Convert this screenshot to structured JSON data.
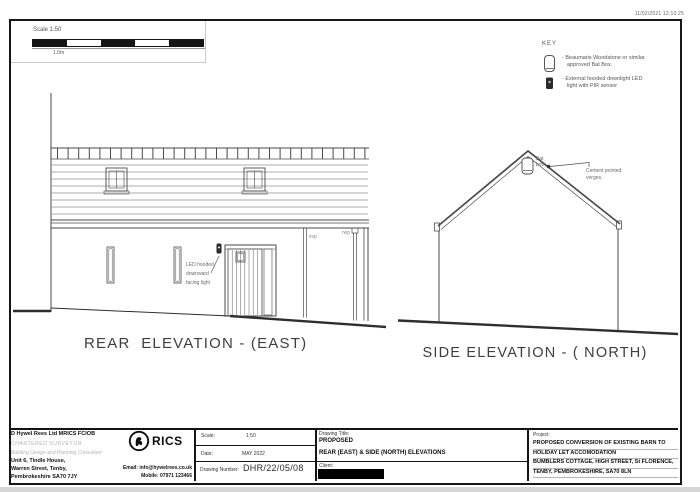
{
  "meta": {
    "timestamp": "11/02/2021 12:10:25"
  },
  "scale_bar": {
    "label": "Scale 1:50",
    "unit_label": "1.0m"
  },
  "key": {
    "title": "KEY",
    "item1_line1": "- Beaumaris Woodstone or similar",
    "item1_line2": "approved Bat Box.",
    "item2_line1": "- External hooded downlight LED",
    "item2_line2": "light with PIR sensor"
  },
  "rear_elevation": {
    "title": "REAR  ELEVATION - (EAST)",
    "led_note_line1": "LED hooded",
    "led_note_line2": "downward",
    "led_note_line3": "facing light",
    "svp_label": "svp",
    "rwp_label": "rwp"
  },
  "side_elevation": {
    "title": "SIDE ELEVATION - ( NORTH)",
    "bat_box_line1": "Bat",
    "bat_box_line2": "box",
    "verges_line1": "Cement pointed",
    "verges_line2": "verges."
  },
  "title_block": {
    "company_name": "D Hywel Rees Ltd MRICS FCIOB",
    "company_role": "CHARTERED SURVEYOR",
    "company_tagline": "Building Design and Planning Consultant",
    "address_line1": "Unit 6, Tindle House,",
    "address_line2": "Warren Street, Tenby,",
    "address_line3": "Pembrokeshire SA70 7JY",
    "email": "Email: info@hywelrees.co.uk",
    "mobile": "Mobile: 07971 123466",
    "rics_logo_text": "RICS",
    "scale_label": "Scale:",
    "scale_value": "1:50",
    "date_label": "Date:",
    "date_value": "MAY 2022",
    "drawing_number_label": "Drawing Number:",
    "drawing_number_value": "DHR/22/05/08",
    "drawing_title_label": "Drawing Title:",
    "drawing_title_line1": "PROPOSED",
    "drawing_title_line2": "REAR (EAST) & SIDE (NORTH) ELEVATIONS",
    "client_label": "Client:",
    "project_label": "Project:",
    "project_line1": "PROPOSED CONVERSION OF EXISTING BARN TO",
    "project_line2": "HOLIDAY LET ACCOMODATION",
    "project_line3": "BUMBLERS COTTAGE, HIGH STREET, St FLORENCE,",
    "project_line4": "TENBY, PEMBROKESHIRE, SA70 8LN"
  }
}
